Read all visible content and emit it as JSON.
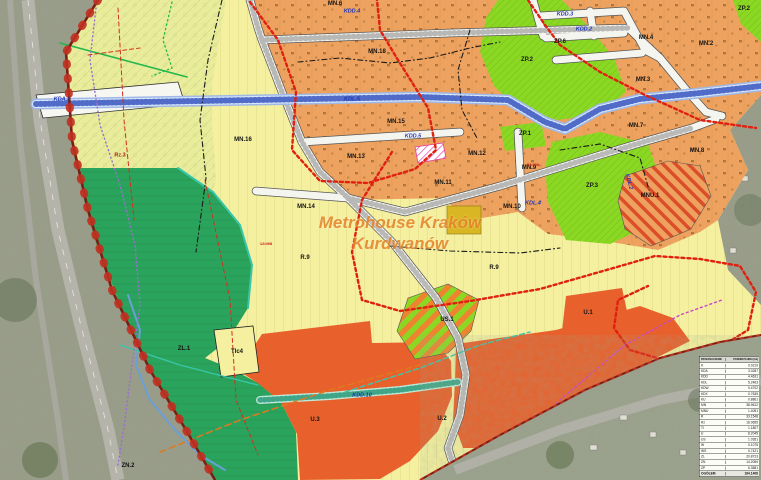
{
  "palette": {
    "aerial_base": "#989b88",
    "agric_yellow": "#f4f0a0",
    "hatched_yellowgreen": "#e9ec9b",
    "residential_orange": "#eea25f",
    "park_green": "#8bd824",
    "forest_green": "#2aa45c",
    "services_red": "#e8612c",
    "mustard_box": "#d9b623",
    "road_white": "#f5f5f0",
    "corridor_blue": "#c8dcf2",
    "corridor_dash": "#3a56c0",
    "boundary_red": "#7a1f12",
    "red_dotted": "#e02010",
    "magenta": "#cc44cc",
    "purple": "#9a6fd0",
    "teal": "#2a9a7a"
  },
  "watermark": {
    "line1": "Metrohouse Kraków",
    "line2": "Kurdwanów"
  },
  "labels": {
    "all": [
      {
        "t": "MN.6",
        "x": 335,
        "y": 4,
        "c": "z"
      },
      {
        "t": "MN.18",
        "x": 377,
        "y": 52,
        "c": "z"
      },
      {
        "t": "MN.16",
        "x": 243,
        "y": 140,
        "c": "z"
      },
      {
        "t": "MN.15",
        "x": 396,
        "y": 122,
        "c": "z"
      },
      {
        "t": "MN.13",
        "x": 356,
        "y": 157,
        "c": "z"
      },
      {
        "t": "MN.12",
        "x": 477,
        "y": 154,
        "c": "z"
      },
      {
        "t": "MN.11",
        "x": 443,
        "y": 183,
        "c": "z"
      },
      {
        "t": "MN.14",
        "x": 306,
        "y": 207,
        "c": "z"
      },
      {
        "t": "MN.10",
        "x": 512,
        "y": 207,
        "c": "z"
      },
      {
        "t": "MN.9",
        "x": 529,
        "y": 168,
        "c": "z"
      },
      {
        "t": "MN.4",
        "x": 646,
        "y": 38,
        "c": "z"
      },
      {
        "t": "MN.2",
        "x": 706,
        "y": 44,
        "c": "z"
      },
      {
        "t": "MN.3",
        "x": 643,
        "y": 80,
        "c": "z"
      },
      {
        "t": "MN.7",
        "x": 636,
        "y": 126,
        "c": "z"
      },
      {
        "t": "MN.8",
        "x": 697,
        "y": 151,
        "c": "z"
      },
      {
        "t": "MNU.1",
        "x": 650,
        "y": 196,
        "c": "z"
      },
      {
        "t": "ZP.2",
        "x": 527,
        "y": 60,
        "c": "z"
      },
      {
        "t": "ZP.2",
        "x": 744,
        "y": 9,
        "c": "z"
      },
      {
        "t": "ZP.6",
        "x": 560,
        "y": 42,
        "c": "z"
      },
      {
        "t": "ZP.1",
        "x": 525,
        "y": 134,
        "c": "z"
      },
      {
        "t": "ZP.3",
        "x": 592,
        "y": 186,
        "c": "z"
      },
      {
        "t": "ZL.1",
        "x": 184,
        "y": 349,
        "c": "z"
      },
      {
        "t": "ZN.2",
        "x": 128,
        "y": 466,
        "c": "z"
      },
      {
        "t": "TIc4",
        "x": 237,
        "y": 352,
        "c": "z"
      },
      {
        "t": "US.1",
        "x": 447,
        "y": 320,
        "c": "z"
      },
      {
        "t": "U.1",
        "x": 588,
        "y": 313,
        "c": "z"
      },
      {
        "t": "U.2",
        "x": 442,
        "y": 419,
        "c": "z"
      },
      {
        "t": "U.3",
        "x": 315,
        "y": 420,
        "c": "z"
      },
      {
        "t": "R.9",
        "x": 305,
        "y": 258,
        "c": "z"
      },
      {
        "t": "R.9",
        "x": 494,
        "y": 268,
        "c": "z"
      },
      {
        "t": "Rz.3",
        "x": 120,
        "y": 156,
        "c": "d"
      },
      {
        "t": "KDA.2",
        "x": 62,
        "y": 100,
        "c": "r"
      },
      {
        "t": "KDL.5",
        "x": 352,
        "y": 100,
        "c": "r"
      },
      {
        "t": "KDD.5",
        "x": 413,
        "y": 137,
        "c": "r"
      },
      {
        "t": "KDD.4",
        "x": 352,
        "y": 12,
        "c": "r"
      },
      {
        "t": "KDD.10",
        "x": 362,
        "y": 396,
        "c": "r"
      },
      {
        "t": "KDL.4",
        "x": 533,
        "y": 204,
        "c": "r"
      },
      {
        "t": "KDD.2",
        "x": 584,
        "y": 30,
        "c": "r"
      },
      {
        "t": "KDD.3",
        "x": 565,
        "y": 15,
        "c": "r"
      },
      {
        "t": "KDL.2",
        "x": 628,
        "y": 182,
        "c": "r",
        "rot": 75
      },
      {
        "t": "12/498",
        "x": 266,
        "y": 244,
        "c": "t"
      },
      {
        "t": "52/498",
        "x": 533,
        "y": 165,
        "c": "t"
      }
    ]
  },
  "legend": {
    "headers": [
      "PRZEZNACZENIE",
      "POWIERZCHNIA [ha]"
    ],
    "rows": [
      [
        "K",
        "0.0219"
      ],
      [
        "KDA",
        "3.0287"
      ],
      [
        "KDD",
        "4.4631"
      ],
      [
        "KDL",
        "5.2463"
      ],
      [
        "KDW",
        "0.4702"
      ],
      [
        "KDX",
        "0.7635"
      ],
      [
        "KU",
        "0.8861"
      ],
      [
        "MN",
        "38.9612"
      ],
      [
        "MNU",
        "1.4051"
      ],
      [
        "R",
        "33.1548"
      ],
      [
        "Rz",
        "16.0655"
      ],
      [
        "TI",
        "1.1807"
      ],
      [
        "U",
        "8.2045"
      ],
      [
        "US",
        "1.0351"
      ],
      [
        "W",
        "0.1075"
      ],
      [
        "WS",
        "0.7421"
      ],
      [
        "ZL",
        "20.8723"
      ],
      [
        "ZN",
        "14.2059"
      ],
      [
        "ZP",
        "6.3581"
      ]
    ],
    "total": [
      "OGÓŁEM",
      "184.1408"
    ]
  }
}
